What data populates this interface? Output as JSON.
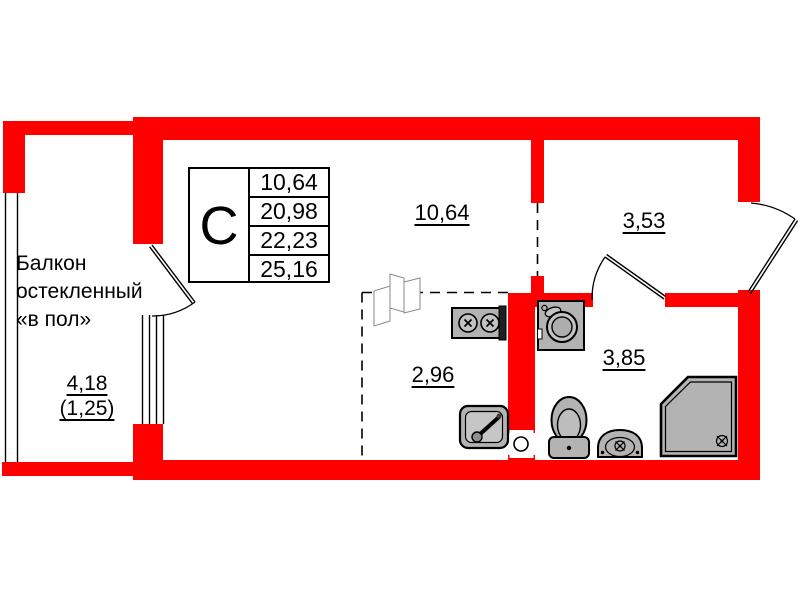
{
  "plan": {
    "type": "studio-apartment-floor-plan",
    "colors": {
      "wall": "#fe0000",
      "fixture": "#b3b3b3",
      "line": "#000000",
      "sketch": "#8a8a8a"
    },
    "info_table": {
      "type_label": "С",
      "rows": [
        "10,64",
        "20,98",
        "22,23",
        "25,16"
      ]
    },
    "rooms": {
      "living": {
        "area": "10,64"
      },
      "hallway": {
        "area": "3,53"
      },
      "kitchen": {
        "area": "2,96"
      },
      "bathroom": {
        "area": "3,85"
      }
    },
    "balcony": {
      "label_lines": [
        "Балкон",
        "остекленный",
        "«в пол»"
      ],
      "area": "4,18",
      "area_reduced": "(1,25)"
    },
    "fixtures": [
      "stove",
      "kitchen-sink",
      "washing-machine",
      "toilet",
      "washbasin",
      "shower-tray",
      "ventilation-hole",
      "folding-door"
    ]
  }
}
